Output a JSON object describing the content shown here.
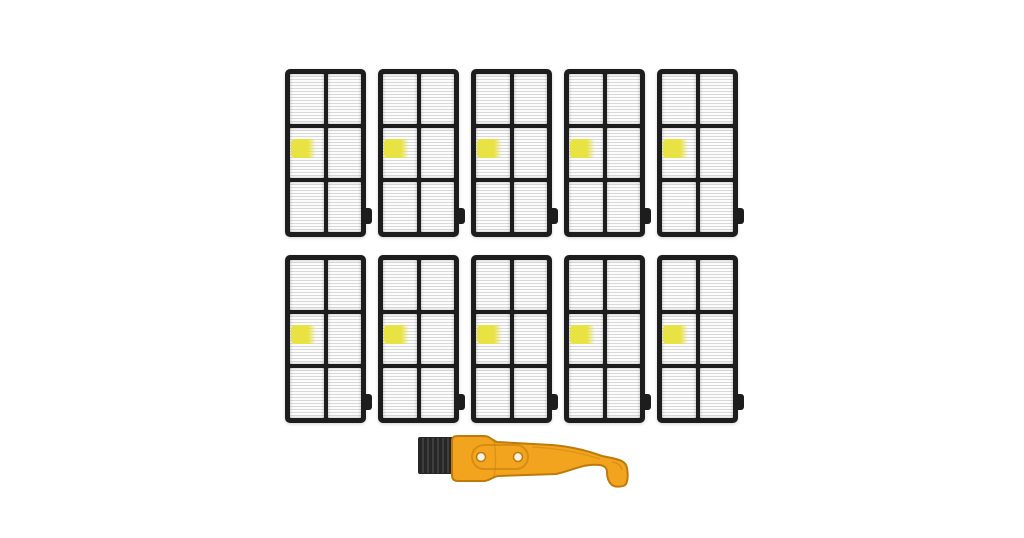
{
  "scene": {
    "type": "product-photo",
    "description": "Ten black-framed white pleated HEPA vacuum filters arranged in two rows of five, each with a small yellow sticker tab, and one yellow cleaning brush tool with black bristles centered below",
    "background_color": "#ffffff"
  },
  "filters": {
    "count": 10,
    "rows": 2,
    "per_row": 5,
    "cell_count": 6,
    "cells_columns": 2,
    "cells_rows": 3,
    "frame_color": "#1d1d1d",
    "media_color": "#fcfcfc",
    "pleat_line_color": "#d9d9d9",
    "sticker_color": "#e9e243"
  },
  "brush": {
    "bristle_color": "#262626",
    "bristle_stripe_color": "#4a4a4a",
    "handle_color": "#f2a41e",
    "handle_outline_color": "#c07a0a",
    "hole_count": 2,
    "hole_fill_color": "#f7f3ea"
  }
}
